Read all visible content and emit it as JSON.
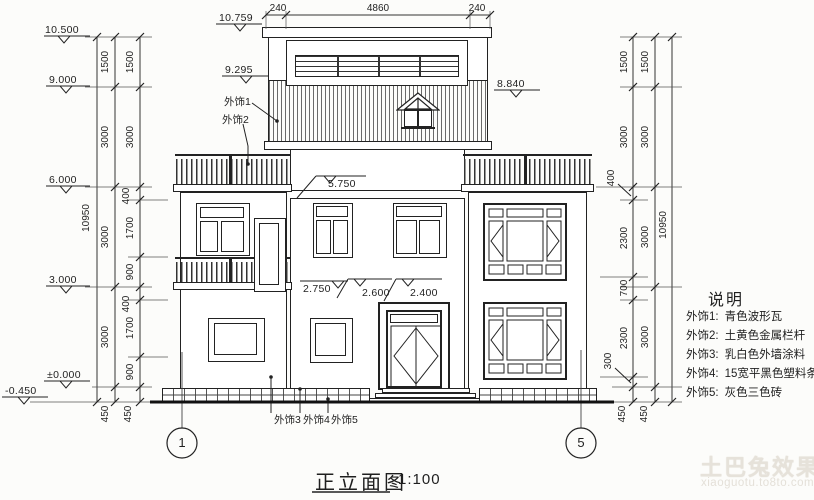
{
  "title": {
    "name": "正立面图",
    "scale": "1:100"
  },
  "legend": {
    "title": "说明",
    "items": [
      {
        "key": "外饰1:",
        "value": "青色波形瓦"
      },
      {
        "key": "外饰2:",
        "value": "土黄色金属栏杆"
      },
      {
        "key": "外饰3:",
        "value": "乳白色外墙涂料"
      },
      {
        "key": "外饰4:",
        "value": "15宽平黑色塑料条嵌缝"
      },
      {
        "key": "外饰5:",
        "value": "灰色三色砖"
      }
    ]
  },
  "levels": {
    "left": [
      "10.500",
      "9.000",
      "6.000",
      "3.000",
      "±0.000",
      "-0.450"
    ],
    "attic": [
      "10.759",
      "9.295",
      "8.840"
    ],
    "mid": [
      "5.750",
      "2.750",
      "2.600",
      "2.400"
    ]
  },
  "callouts": [
    "外饰1",
    "外饰2",
    "外饰3",
    "外饰4",
    "外饰5"
  ],
  "axis": {
    "left": "1",
    "right": "5"
  },
  "dims": {
    "top": [
      "240",
      "4860",
      "240"
    ],
    "overall": "10950",
    "left_floors": [
      "1500",
      "3000",
      "3000",
      "3000",
      "450"
    ],
    "left_detail": [
      "1500",
      "3000",
      "400",
      "1700",
      "900",
      "400",
      "1700",
      "900",
      "450"
    ],
    "right_detail": [
      "1500",
      "3000",
      "400",
      "2300",
      "700",
      "2300",
      "300",
      "450"
    ],
    "right_floors": [
      "1500",
      "3000",
      "3000",
      "3000",
      "450"
    ]
  },
  "watermark": {
    "brand": "土巴兔效果图",
    "url": "xiaoguotu.to8to.com"
  },
  "colors": {
    "line": "#222222",
    "background": "#fcfcfa",
    "watermark": "#e6e2da"
  }
}
